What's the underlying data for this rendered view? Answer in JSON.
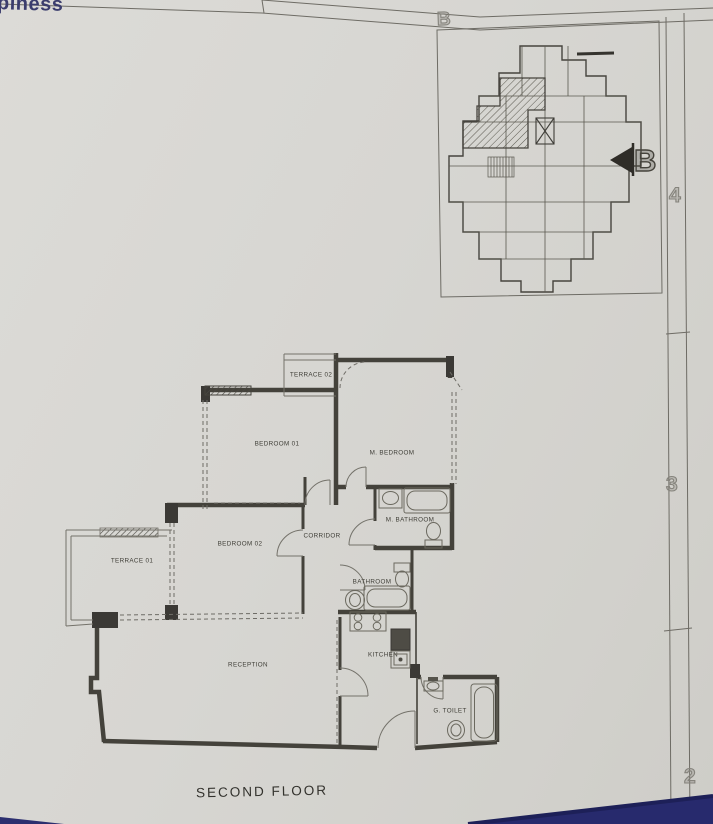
{
  "colors": {
    "paper": "#d7d6d2",
    "thin_line": "#74726a",
    "wall": "#44423b",
    "blue_accent": "#2a2d6e",
    "label_text": "#3f3e37"
  },
  "header": {
    "logo_partial": "piness",
    "grid_column_label": "B"
  },
  "grid_rows": [
    {
      "label": "4"
    },
    {
      "label": "3"
    },
    {
      "label": "2"
    }
  ],
  "key_plan": {
    "section_marker_label": "B"
  },
  "floor_plan": {
    "title": "SECOND FLOOR",
    "rooms": [
      {
        "id": "terrace-02",
        "label": "TERRACE 02"
      },
      {
        "id": "bedroom-01",
        "label": "BEDROOM 01"
      },
      {
        "id": "m-bedroom",
        "label": "M. BEDROOM"
      },
      {
        "id": "bedroom-02",
        "label": "BEDROOM 02"
      },
      {
        "id": "corridor",
        "label": "CORRIDOR"
      },
      {
        "id": "terrace-01",
        "label": "TERRACE 01"
      },
      {
        "id": "m-bathroom",
        "label": "M. BATHROOM"
      },
      {
        "id": "bathroom",
        "label": "BATHROOM"
      },
      {
        "id": "reception",
        "label": "RECEPTION"
      },
      {
        "id": "kitchen",
        "label": "KITCHEN"
      },
      {
        "id": "g-toilet",
        "label": "G. TOILET"
      }
    ]
  }
}
